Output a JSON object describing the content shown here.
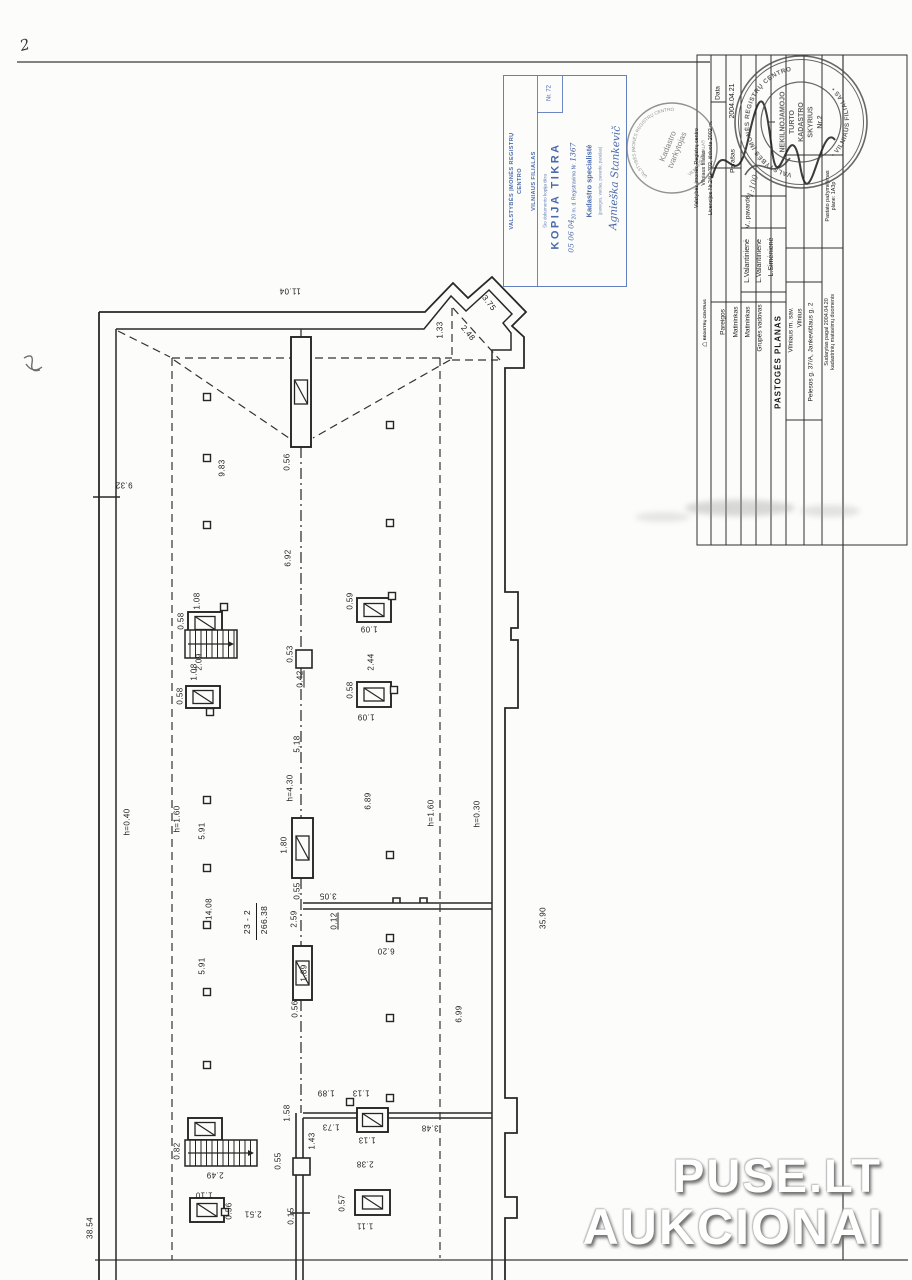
{
  "page": {
    "corner_mark": "2",
    "watermark": {
      "line1": "PUSE.LT",
      "line2": "AUKCIONAI"
    }
  },
  "blue_stamp": {
    "org_line1": "VALSTYBĖS ĮMONĖS REGISTRŲ CENTRO",
    "org_line2": "VILNIAUS FILIALAS",
    "nr_label": "Nr. 72",
    "small_line": "Šio dokumento kopija tikra",
    "title": "KOPIJA TIKRA",
    "reg_line_printed": "20     m.          d.  Registravimo Nr.",
    "reg_line_hw_date": "05 06 04",
    "reg_line_hw_nr": "1367",
    "position_line": "Kadastro specialistė",
    "position_note": "(pareigos, vardas, pavardė, parašas)",
    "signature_name": "Agnieška Stankevič"
  },
  "round_stamp_small": {
    "ring_top": "VALSTYBĖS ĮMONĖS REGISTRŲ CENTRO",
    "ring_bottom": "VILNIAUS FILIALAS",
    "center_line1": "Kadastro",
    "center_line2": "tvarkytojas"
  },
  "round_stamp_large": {
    "ring_top": "VALSTYBĖS ĮMONĖS REGISTRŲ CENTRO",
    "ring_bottom": "• VILNIAUS FILIALAS •",
    "center_lines": "I\nNEKILNOJAMOJO\nTURTO\nKADASTRO\nSKYRIUS\nNr.2"
  },
  "title_block": {
    "org_text": "Valstybės įmonės Registrų centro\nVilniaus filialas\nLicencijos Nr.24G-302, išduota 2002 m.",
    "logo_text": "REGISTRŲ CENTRAS",
    "col_data": "Data",
    "date_value": "2004.04.21",
    "col_parasas": "Parašas",
    "col_pavarde": "V., pavardė",
    "name1": "L.Valantinienė",
    "name2": "L.Valantinienė",
    "name3": "L.Simėnienė",
    "col_pareigos": "Pareigos",
    "role1": "Matininkas",
    "role2": "Matininkas",
    "role3": "Grupės vadovas",
    "doc_title": "PASTOGĖS  PLANAS",
    "scale_hw": "1:100",
    "addr1": "Vilniaus m. sav.",
    "addr2": "Vilnius",
    "addr3": "Pelesos g. 37/A, Jankevičiaus g. 2",
    "made_note": "Sudarytas pagal 2004.04.20\nkadastrinių matavimų duomenis",
    "building_note": "Pastato pažymėjimas\nplane: 1A3p"
  },
  "plan": {
    "room_label": {
      "number": "23 - 2",
      "area": "266.38"
    },
    "dimensions": [
      {
        "t": "11.04",
        "x": 290,
        "y": 291,
        "r": 180
      },
      {
        "t": "1.33",
        "x": 440,
        "y": 330,
        "r": -90
      },
      {
        "t": "3.75",
        "x": 489,
        "y": 303,
        "r": 52
      },
      {
        "t": "2.48",
        "x": 468,
        "y": 333,
        "r": 50
      },
      {
        "t": "9.83",
        "x": 222,
        "y": 468,
        "r": -90
      },
      {
        "t": "0.56",
        "x": 287,
        "y": 462,
        "r": -90
      },
      {
        "t": "9.32",
        "x": 124,
        "y": 485,
        "r": 180
      },
      {
        "t": "6.92",
        "x": 288,
        "y": 558,
        "r": -90
      },
      {
        "t": "1.08",
        "x": 197,
        "y": 601,
        "r": -90
      },
      {
        "t": "0.58",
        "x": 181,
        "y": 621,
        "r": -90
      },
      {
        "t": "2.09",
        "x": 199,
        "y": 662,
        "r": -90
      },
      {
        "t": "1.08",
        "x": 194,
        "y": 672,
        "r": -90
      },
      {
        "t": "0.58",
        "x": 180,
        "y": 696,
        "r": -90
      },
      {
        "t": "0.59",
        "x": 350,
        "y": 601,
        "r": -90
      },
      {
        "t": "1.09",
        "x": 369,
        "y": 629,
        "r": 180
      },
      {
        "t": "2.44",
        "x": 371,
        "y": 662,
        "r": -90
      },
      {
        "t": "0.58",
        "x": 350,
        "y": 690,
        "r": -90
      },
      {
        "t": "1.09",
        "x": 366,
        "y": 717,
        "r": 180
      },
      {
        "t": "0.53",
        "x": 290,
        "y": 654,
        "r": -90
      },
      {
        "t": "0.42",
        "x": 300,
        "y": 679,
        "r": -90,
        "u": true
      },
      {
        "t": "5.18",
        "x": 297,
        "y": 744,
        "r": -90
      },
      {
        "t": "h=4.30",
        "x": 290,
        "y": 788,
        "r": -90
      },
      {
        "t": "6.89",
        "x": 368,
        "y": 801,
        "r": -90
      },
      {
        "t": "h=1.60",
        "x": 177,
        "y": 819,
        "r": -90
      },
      {
        "t": "h=0.40",
        "x": 127,
        "y": 822,
        "r": -90
      },
      {
        "t": "h=1.60",
        "x": 431,
        "y": 813,
        "r": -90
      },
      {
        "t": "h=0.30",
        "x": 477,
        "y": 814,
        "r": -90
      },
      {
        "t": "5.91",
        "x": 202,
        "y": 831,
        "r": -90
      },
      {
        "t": "1.80",
        "x": 284,
        "y": 845,
        "r": -90
      },
      {
        "t": "0.55",
        "x": 297,
        "y": 891,
        "r": -90
      },
      {
        "t": "14.08",
        "x": 209,
        "y": 909,
        "r": -90
      },
      {
        "t": "2.59",
        "x": 294,
        "y": 919,
        "r": -90
      },
      {
        "t": "3.05",
        "x": 328,
        "y": 896,
        "r": 180
      },
      {
        "t": "0.12",
        "x": 334,
        "y": 921,
        "r": -90,
        "u": true
      },
      {
        "t": "6.20",
        "x": 386,
        "y": 951,
        "r": 180
      },
      {
        "t": "35.90",
        "x": 543,
        "y": 918,
        "r": -90
      },
      {
        "t": "5.91",
        "x": 202,
        "y": 966,
        "r": -90
      },
      {
        "t": "1.89",
        "x": 304,
        "y": 973,
        "r": -90
      },
      {
        "t": "0.56",
        "x": 295,
        "y": 1009,
        "r": -90
      },
      {
        "t": "6.99",
        "x": 459,
        "y": 1014,
        "r": -90
      },
      {
        "t": "1.89",
        "x": 326,
        "y": 1093,
        "r": 180
      },
      {
        "t": "1.13",
        "x": 361,
        "y": 1093,
        "r": 180
      },
      {
        "t": "1.58",
        "x": 287,
        "y": 1113,
        "r": -90
      },
      {
        "t": "1.73",
        "x": 331,
        "y": 1127,
        "r": 180
      },
      {
        "t": "1.43",
        "x": 312,
        "y": 1141,
        "r": -90
      },
      {
        "t": "1.13",
        "x": 367,
        "y": 1140,
        "r": 180
      },
      {
        "t": "3.48",
        "x": 430,
        "y": 1128,
        "r": 180
      },
      {
        "t": "0.82",
        "x": 177,
        "y": 1151,
        "r": -90
      },
      {
        "t": "0.55",
        "x": 278,
        "y": 1161,
        "r": -90
      },
      {
        "t": "2.38",
        "x": 365,
        "y": 1164,
        "r": 180
      },
      {
        "t": "2.49",
        "x": 215,
        "y": 1175,
        "r": 180
      },
      {
        "t": "1.10",
        "x": 204,
        "y": 1195,
        "r": 180
      },
      {
        "t": "0.57",
        "x": 342,
        "y": 1203,
        "r": -90
      },
      {
        "t": "0.56",
        "x": 229,
        "y": 1211,
        "r": -90
      },
      {
        "t": "2.51",
        "x": 253,
        "y": 1214,
        "r": 180
      },
      {
        "t": "0.15",
        "x": 291,
        "y": 1216,
        "r": -90
      },
      {
        "t": "1.11",
        "x": 365,
        "y": 1226,
        "r": 180
      },
      {
        "t": "38.54",
        "x": 90,
        "y": 1228,
        "r": -90
      }
    ]
  }
}
